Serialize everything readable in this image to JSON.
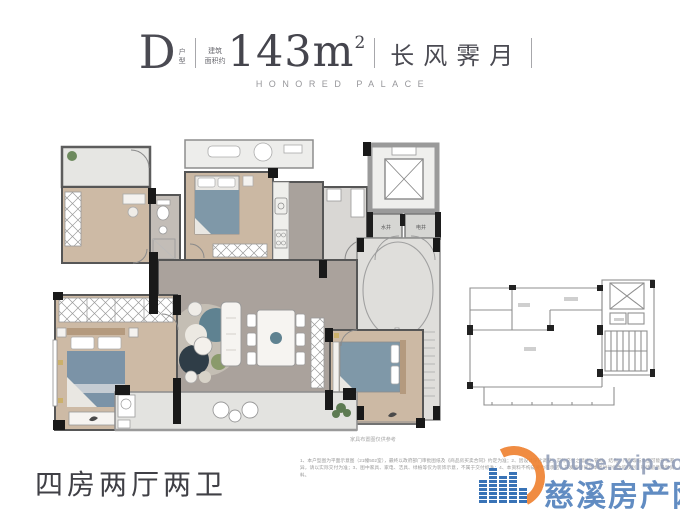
{
  "header": {
    "unit_letter": "D",
    "unit_label": "户型",
    "area_label_1": "建筑",
    "area_label_2": "面积约",
    "area_value": "143m",
    "area_exp": "2",
    "project_name": "长风霁月",
    "project_name_en": "HONORED PALACE"
  },
  "plan": {
    "caption": "家具布置图仅供参考",
    "shafts": {
      "water": "水井",
      "electric": "电井"
    }
  },
  "footer": {
    "layout_title": "四房两厅两卫",
    "disclaimer": "1、本户型图为平面示意图（21幢502室），最终以政府部门审批图纸及《商品房买卖合同》约定为准；2、因设计深化调整，实际交付之墙体、管线、结构、门窗等与本图可能存在差异，请以实际交付为准；3、图中家具、家电、洁具、绿植等仅为装饰示意，不属于交付标准；4、本资料不构成要约或承诺，开发商保留对本图进行修改的权利，敬请留意最新资料。"
  },
  "watermark": {
    "url": "house.zxip.com",
    "name": "慈溪房产网"
  },
  "colors": {
    "accent_orange": "#ef8332",
    "brand_blue": "#2f6cb3",
    "wall_dark": "#1a1a1a",
    "wood_floor": "#cbb8a3",
    "living_floor": "#aaa29c",
    "bed_blue": "#7b93a7",
    "title_gray": "#4a4a52"
  }
}
